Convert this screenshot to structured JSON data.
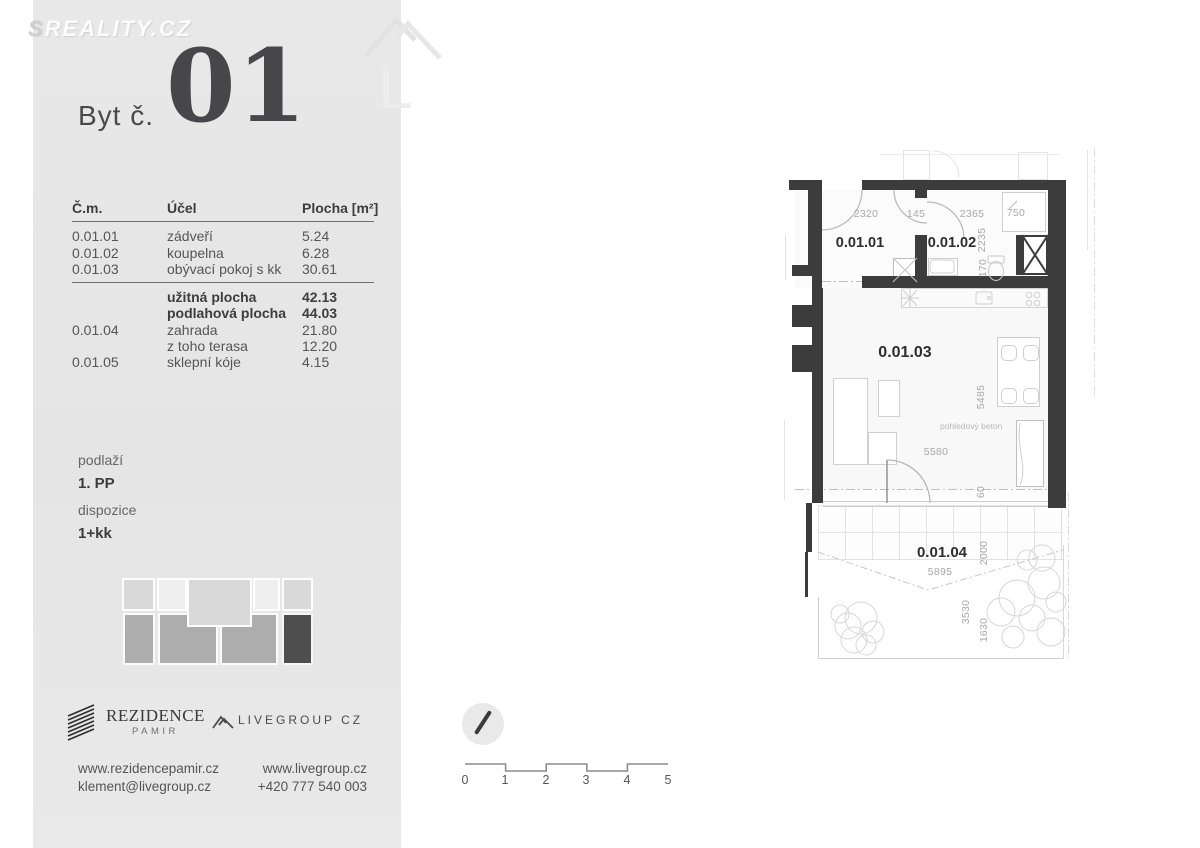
{
  "watermark": {
    "brand_first": "S",
    "brand_rest": "REALITY.CZ",
    "ghost_letter": "L"
  },
  "header": {
    "label": "Byt č.",
    "number": "01"
  },
  "table": {
    "headers": {
      "num": "Č.m.",
      "purpose": "Účel",
      "area": "Plocha [m²]"
    },
    "rows": [
      {
        "num": "0.01.01",
        "purpose": "zádveří",
        "area": "5.24"
      },
      {
        "num": "0.01.02",
        "purpose": "koupelna",
        "area": "6.28"
      },
      {
        "num": "0.01.03",
        "purpose": "obývací pokoj s kk",
        "area": "30.61"
      }
    ],
    "summary": [
      {
        "num": "",
        "purpose": "užitná plocha",
        "area": "42.13"
      },
      {
        "num": "",
        "purpose": "podlahová plocha",
        "area": "44.03"
      },
      {
        "num": "0.01.04",
        "purpose": "zahrada",
        "area": "21.80"
      },
      {
        "num": "",
        "purpose": "z toho terasa",
        "area": "12.20"
      },
      {
        "num": "0.01.05",
        "purpose": "sklepní kóje",
        "area": "4.15"
      }
    ]
  },
  "info": {
    "floor_label": "podlaží",
    "floor_value": "1. PP",
    "layout_label": "dispozice",
    "layout_value": "1+kk"
  },
  "logos": {
    "rezidence_line1": "REZIDENCE",
    "rezidence_line2": "PAMIR",
    "livegroup": "LIVEGROUP CZ"
  },
  "contact": {
    "web1": "www.rezidencepamir.cz",
    "email": "klement@livegroup.cz",
    "web2": "www.livegroup.cz",
    "phone": "+420 777 540 003"
  },
  "scale": {
    "labels": [
      "0",
      "1",
      "2",
      "3",
      "4",
      "5"
    ]
  },
  "plan": {
    "rooms": [
      {
        "id": "0.01.01"
      },
      {
        "id": "0.01.02"
      },
      {
        "id": "0.01.03"
      },
      {
        "id": "0.01.04"
      }
    ],
    "dims": [
      "2320",
      "145",
      "2365",
      "750",
      "2235",
      "170",
      "5485",
      "5580",
      "5895",
      "2000",
      "60",
      "3530",
      "1630"
    ],
    "note": "pohledový beton"
  },
  "colors": {
    "wall": "#3c3c3c",
    "panel": "#e6e6e6",
    "accent_text": "#47474b",
    "diagram_light": "#d9d9d9",
    "diagram_lighter": "#efefef",
    "diagram_mid": "#adadad",
    "diagram_dark": "#4e4e4e"
  }
}
